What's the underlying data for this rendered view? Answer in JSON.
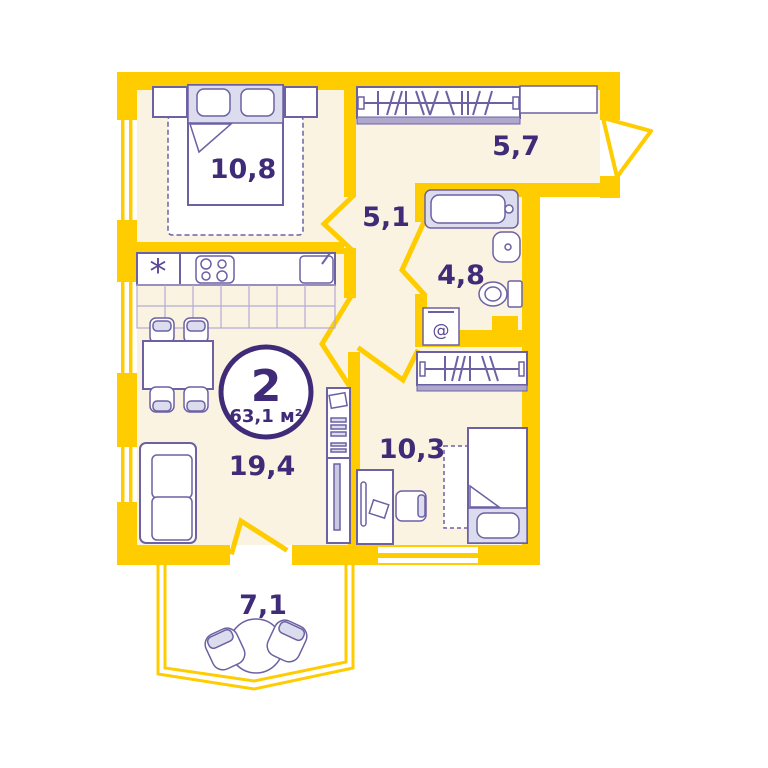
{
  "plan": {
    "title": "2-room apartment floor plan",
    "badge": {
      "rooms_count": "2",
      "total_area": "63,1 м²"
    },
    "rooms": [
      {
        "id": "bedroom",
        "area": "10,8"
      },
      {
        "id": "hallway",
        "area": "5,7"
      },
      {
        "id": "corridor",
        "area": "5,1"
      },
      {
        "id": "bathroom",
        "area": "4,8"
      },
      {
        "id": "kids-room",
        "area": "10,3"
      },
      {
        "id": "living-kitchen",
        "area": "19,4"
      },
      {
        "id": "balcony",
        "area": "7,1"
      }
    ],
    "icons": {
      "fridge_asterisk": "*",
      "washer_at": "@"
    },
    "colors": {
      "wall_yellow": "#FFCC00",
      "floor_cream": "#FBF3E2",
      "furniture_outline": "#6C61A3",
      "label_purple": "#3F2B77",
      "accent_lavender": "#DCDCEF"
    }
  }
}
